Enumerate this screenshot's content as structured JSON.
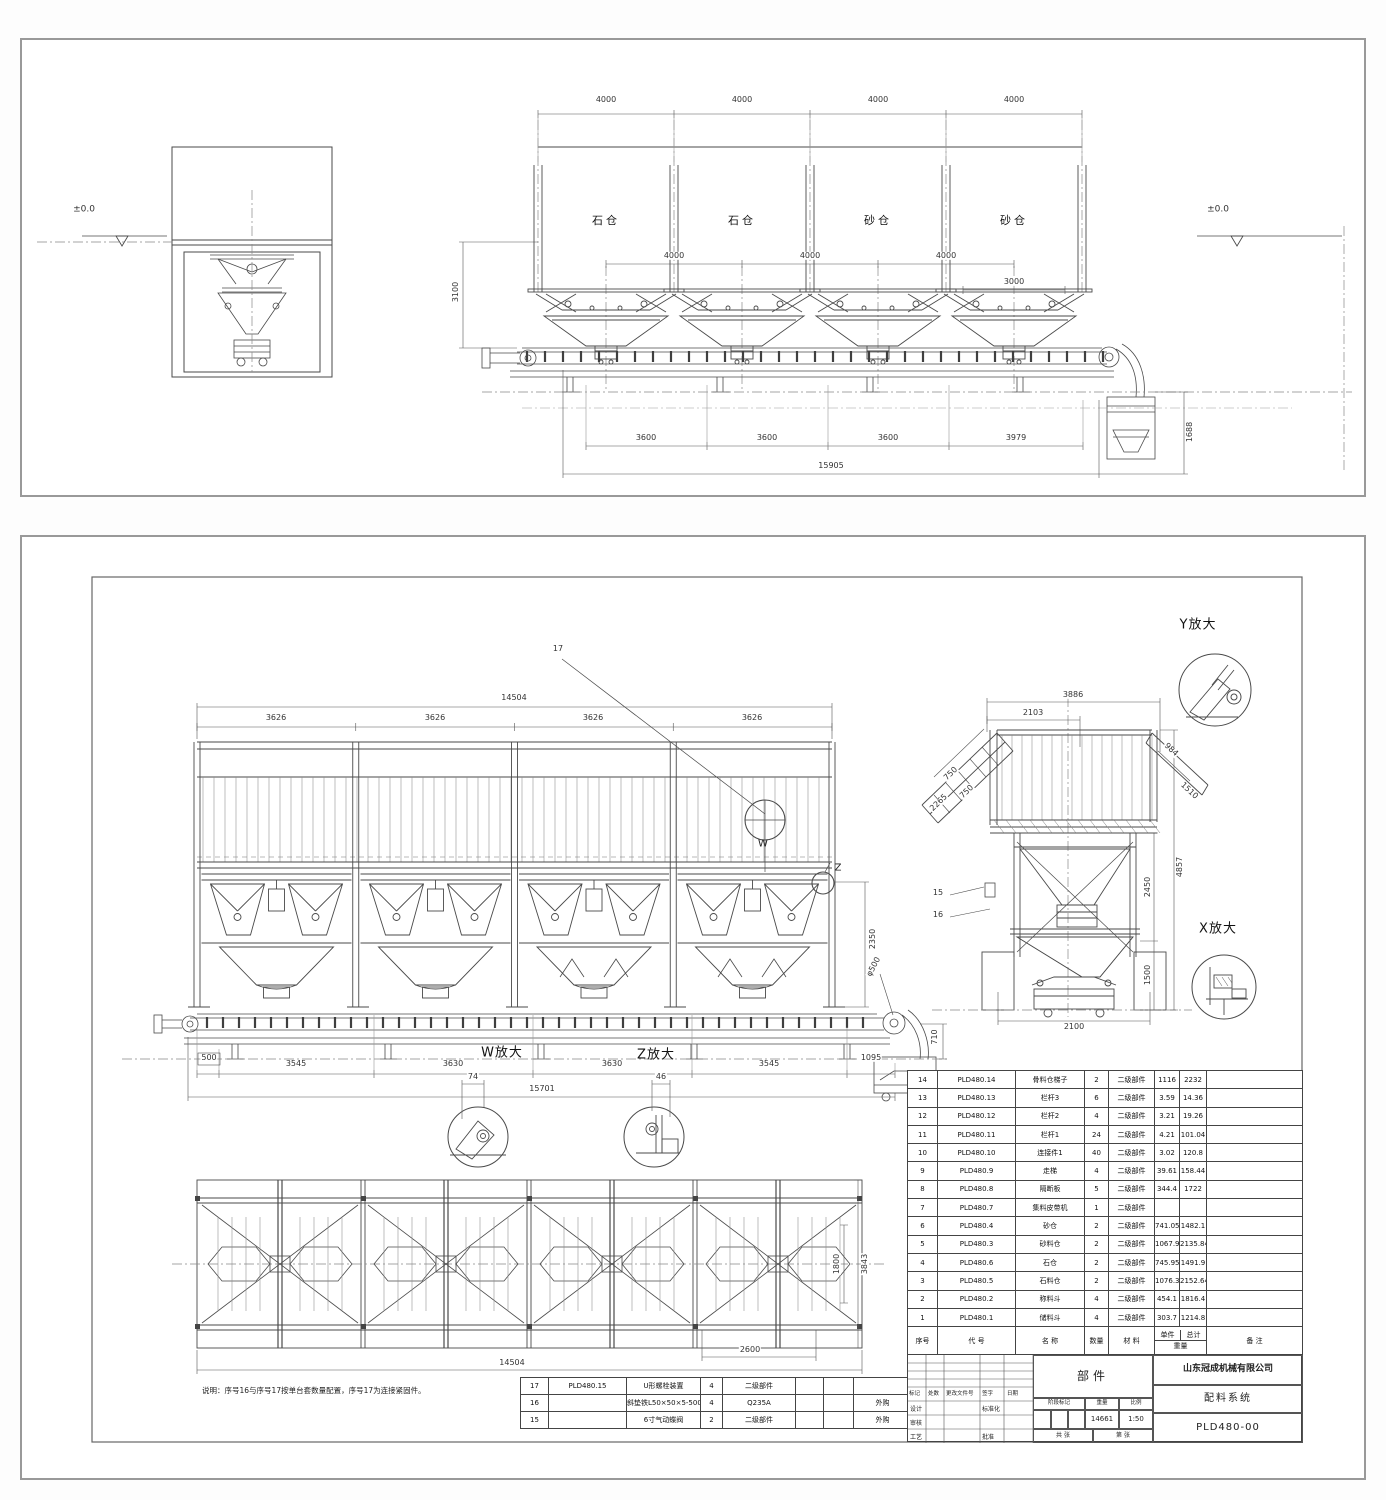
{
  "top_view": {
    "datum_left": "±0.0",
    "datum_right": "±0.0",
    "bay_dims": [
      "4000",
      "4000",
      "4000",
      "4000"
    ],
    "bin_labels": [
      "石仓",
      "石仓",
      "砂仓",
      "砂仓"
    ],
    "inner_dims": [
      "4000",
      "4000",
      "4000"
    ],
    "dim_3000": "3000",
    "height_3100": "3100",
    "bottom_dims": [
      "3600",
      "3600",
      "3600",
      "3979"
    ],
    "overall_length": "15905",
    "pit_height": "1688"
  },
  "front_view": {
    "overall_top": "14504",
    "bay_dims": [
      "3626",
      "3626",
      "3626",
      "3626"
    ],
    "item_leader": "17",
    "detail_w_mark": "W",
    "detail_z_mark": "Z",
    "height_2350": "2350",
    "pulley_dia": "φ500",
    "height_710": "710",
    "bottom_dims": [
      "500",
      "3545",
      "3630",
      "3630",
      "3545",
      "1095"
    ],
    "overall_bottom": "15701"
  },
  "details": {
    "w_title": "W放大",
    "w_dim": "74",
    "z_title": "Z放大",
    "z_dim": "46",
    "y_title": "Y放大",
    "x_title": "X放大"
  },
  "side_view": {
    "overall_width": "3886",
    "left_width": "2103",
    "slope_dim_a": "750",
    "slope_dim_b": "750",
    "slope_dim_c": "2265",
    "right_slope_a": "984",
    "right_slope_b": "1510",
    "overall_height": "4857",
    "mid_height": "2450",
    "base_height": "1500",
    "base_width": "2100",
    "leader_15": "15",
    "leader_16": "16"
  },
  "plan_view": {
    "overall": "14504",
    "dim_2600": "2600",
    "dim_1800": "1800",
    "dim_3843": "3843"
  },
  "note": "说明：序号16与序号17按单台套数量配置，序号17为连接紧固件。",
  "bom": {
    "col_headers": {
      "no": "序号",
      "code": "代  号",
      "name": "名  称",
      "qty": "数量",
      "material": "材  料",
      "unit": "单件",
      "total": "总计",
      "weight": "重量",
      "remark": "备  注"
    },
    "rows": [
      {
        "no": "14",
        "code": "PLD480.14",
        "name": "骨料仓梯子",
        "qty": "2",
        "material": "二级部件",
        "unit": "1116",
        "total": "2232",
        "remark": ""
      },
      {
        "no": "13",
        "code": "PLD480.13",
        "name": "栏杆3",
        "qty": "6",
        "material": "二级部件",
        "unit": "3.59",
        "total": "14.36",
        "remark": ""
      },
      {
        "no": "12",
        "code": "PLD480.12",
        "name": "栏杆2",
        "qty": "4",
        "material": "二级部件",
        "unit": "3.21",
        "total": "19.26",
        "remark": ""
      },
      {
        "no": "11",
        "code": "PLD480.11",
        "name": "栏杆1",
        "qty": "24",
        "material": "二级部件",
        "unit": "4.21",
        "total": "101.04",
        "remark": ""
      },
      {
        "no": "10",
        "code": "PLD480.10",
        "name": "连接件1",
        "qty": "40",
        "material": "二级部件",
        "unit": "3.02",
        "total": "120.8",
        "remark": ""
      },
      {
        "no": "9",
        "code": "PLD480.9",
        "name": "走梯",
        "qty": "4",
        "material": "二级部件",
        "unit": "39.61",
        "total": "158.44",
        "remark": ""
      },
      {
        "no": "8",
        "code": "PLD480.8",
        "name": "隔断板",
        "qty": "5",
        "material": "二级部件",
        "unit": "344.4",
        "total": "1722",
        "remark": ""
      },
      {
        "no": "7",
        "code": "PLD480.7",
        "name": "集料皮带机",
        "qty": "1",
        "material": "二级部件",
        "unit": "",
        "total": "",
        "remark": ""
      },
      {
        "no": "6",
        "code": "PLD480.4",
        "name": "砂仓",
        "qty": "2",
        "material": "二级部件",
        "unit": "741.05",
        "total": "1482.1",
        "remark": ""
      },
      {
        "no": "5",
        "code": "PLD480.3",
        "name": "砂料仓",
        "qty": "2",
        "material": "二级部件",
        "unit": "1067.92",
        "total": "2135.84",
        "remark": ""
      },
      {
        "no": "4",
        "code": "PLD480.6",
        "name": "石仓",
        "qty": "2",
        "material": "二级部件",
        "unit": "745.95",
        "total": "1491.9",
        "remark": ""
      },
      {
        "no": "3",
        "code": "PLD480.5",
        "name": "石料仓",
        "qty": "2",
        "material": "二级部件",
        "unit": "1076.32",
        "total": "2152.64",
        "remark": ""
      },
      {
        "no": "2",
        "code": "PLD480.2",
        "name": "称料斗",
        "qty": "4",
        "material": "二级部件",
        "unit": "454.1",
        "total": "1816.4",
        "remark": ""
      },
      {
        "no": "1",
        "code": "PLD480.1",
        "name": "储料斗",
        "qty": "4",
        "material": "二级部件",
        "unit": "303.7",
        "total": "1214.8",
        "remark": ""
      }
    ],
    "extra_rows": [
      {
        "no": "17",
        "code": "PLD480.15",
        "name": "U形螺栓装置",
        "qty": "4",
        "material": "二级部件",
        "unit": "",
        "total": "",
        "remark": ""
      },
      {
        "no": "16",
        "code": "",
        "name": "斜垫铁L50×50×5-500",
        "qty": "4",
        "material": "Q235A",
        "unit": "",
        "total": "",
        "remark": "外购"
      },
      {
        "no": "15",
        "code": "",
        "name": "6寸气动蝶阀",
        "qty": "2",
        "material": "二级部件",
        "unit": "",
        "total": "",
        "remark": "外购"
      }
    ]
  },
  "title_block": {
    "company": "山东冠成机械有限公司",
    "part_label": "部件",
    "product": "配料系统",
    "drawing_no": "PLD480-00",
    "weight_value": "14661",
    "scale_value": "1:50",
    "fields": {
      "mark": "标记",
      "count": "处数",
      "change_doc": "更改文件号",
      "sign": "签字",
      "date": "日期",
      "design": "设计",
      "check": "审核",
      "craft": "工艺",
      "standardize": "标准化",
      "approve": "批准",
      "stage": "阶段标记",
      "weight": "重量",
      "scale": "比例",
      "sheets": "共 张",
      "sheet_no": "第 张"
    }
  }
}
